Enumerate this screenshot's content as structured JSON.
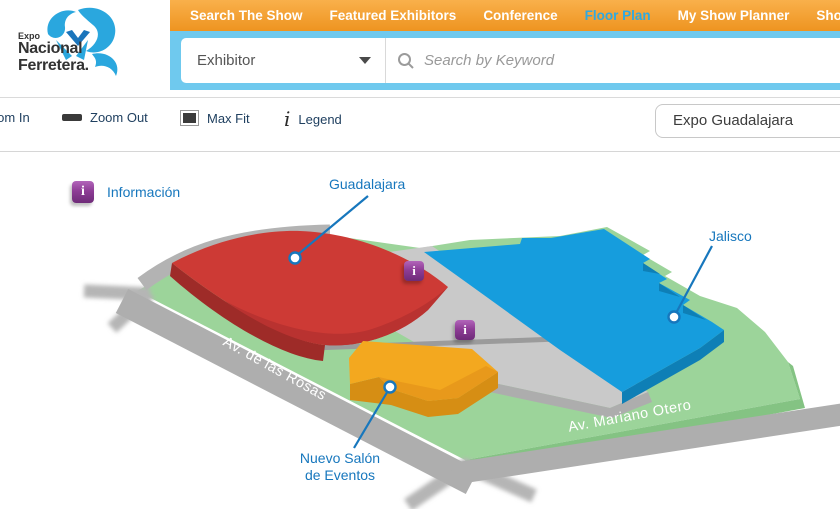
{
  "header": {
    "logo": {
      "line1": "Expo",
      "line2": "Nacional",
      "line3": "Ferretera."
    },
    "nav": {
      "items": [
        {
          "label": "Search The Show",
          "active": false
        },
        {
          "label": "Featured Exhibitors",
          "active": false
        },
        {
          "label": "Conference",
          "active": false
        },
        {
          "label": "Floor Plan",
          "active": true
        },
        {
          "label": "My Show Planner",
          "active": false
        },
        {
          "label": "Show Webs",
          "active": false
        }
      ]
    },
    "search": {
      "category_value": "Exhibitor",
      "keyword_placeholder": "Search by Keyword"
    }
  },
  "toolbar": {
    "zoom_in_label": "Zoom In",
    "zoom_out_label": "Zoom Out",
    "max_fit_label": "Max Fit",
    "legend_label": "Legend",
    "venue_value": "Expo Guadalajara"
  },
  "map": {
    "legend_item_label": "Información",
    "info_glyph": "i",
    "labels": {
      "guadalajara": "Guadalajara",
      "jalisco": "Jalisco",
      "nuevo_salon_line1": "Nuevo Salón",
      "nuevo_salon_line2": "de Eventos"
    },
    "streets": {
      "rosas": "Av. de las Rosas",
      "mariano": "Av. Mariano Otero"
    }
  },
  "colors": {
    "nav_orange": "#f29c2e",
    "nav_active_blue": "#2fa9e1",
    "strip_blue": "#6fc9ee",
    "label_blue": "#1777bd",
    "building_red": "#cd3a35",
    "building_blue": "#169ddd",
    "building_yellow": "#f3a81f",
    "ground_green": "#9cd49a",
    "road_gray": "#aeaeae",
    "marker_purple": "#8e3d96"
  }
}
